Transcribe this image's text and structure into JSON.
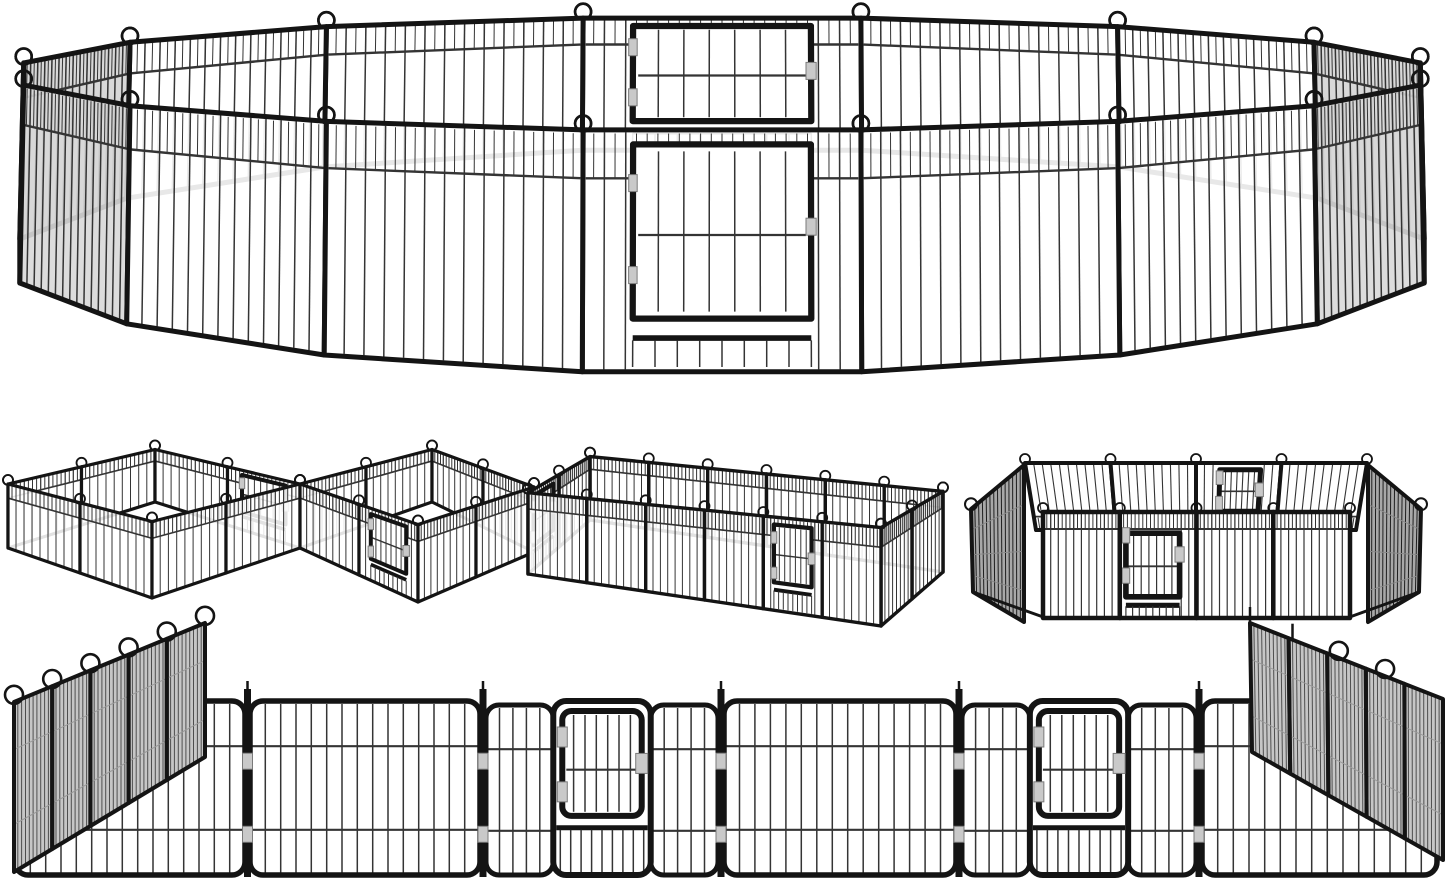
{
  "image": {
    "alt": "Heavy-duty black metal 16-panel pet playpen fence shown in five layouts: a large ring with front and back walk-through gates, two linked diamond pens, a long rectangular run, a square pen with two gates, and the panels unfolded flat in a row with folded wing stacks",
    "background": "#ffffff"
  },
  "product": {
    "frame_color": "#141414",
    "bar_color": "#343434",
    "hinge_color": "#c9c9c9",
    "hinge_edge_color": "#7a7a7a",
    "mesh_fill": "#c6c6c6",
    "side_mesh_fill": "#d8d8d8",
    "edge_mesh_fill": "#9f9f9f",
    "dark_mesh_fill": "#a8a8a8",
    "panel_count_per_view": 16,
    "gate_count": 2
  },
  "views": [
    {
      "id": "ring",
      "label": "16-panel ring configuration with front gate and back gate"
    },
    {
      "id": "double-square",
      "label": "two linked diamond pens with two gates"
    },
    {
      "id": "long-rectangle",
      "label": "long rectangular run with end gate and side gate"
    },
    {
      "id": "square",
      "label": "square pen with back gate and front gate"
    },
    {
      "id": "flat-row",
      "label": "panels laid flat in a row with connecting rods and folded wing stacks"
    }
  ]
}
